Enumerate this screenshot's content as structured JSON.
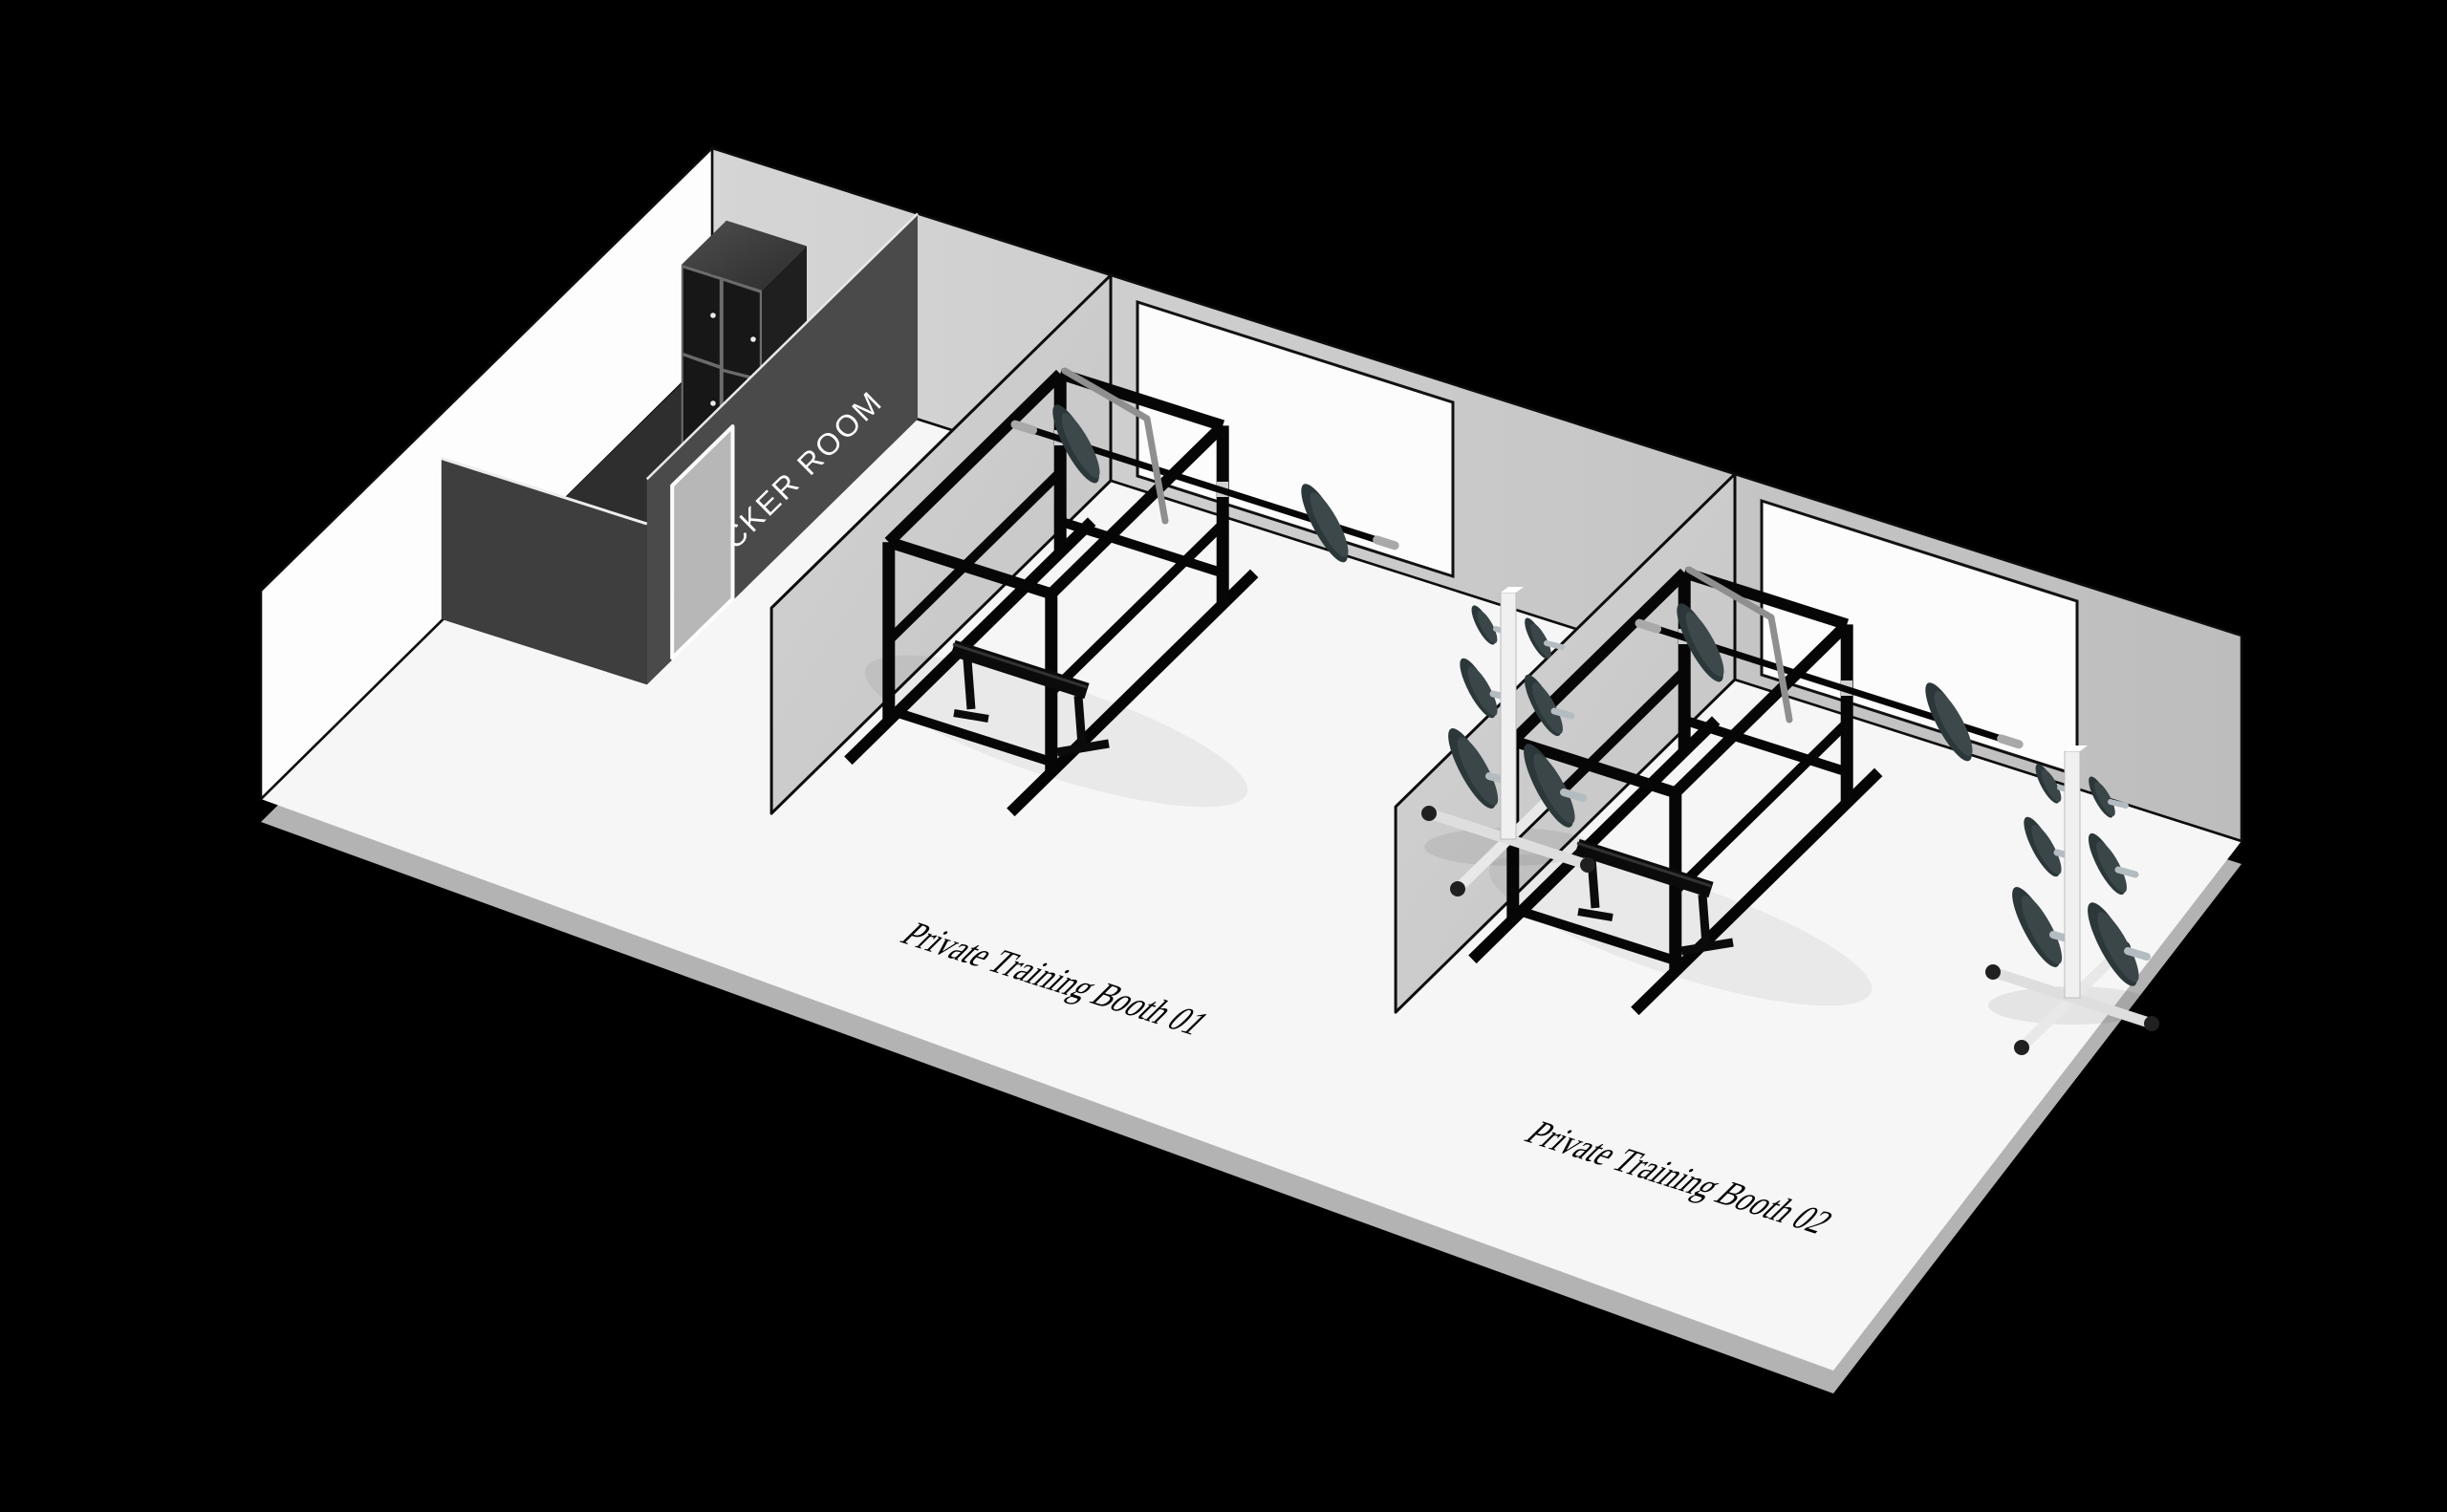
{
  "scene": {
    "type": "isometric-gym-floorplan-illustration",
    "background_color": "#000000",
    "locker_room": {
      "label": "LOCKER ROOM",
      "text_color": "#ffffff",
      "wall_color": "#4a4a4a",
      "objects": [
        "locker-cabinet-4-doors",
        "door"
      ]
    },
    "booths": [
      {
        "id": "01",
        "label": "Private Training Booth 01",
        "equipment": [
          "power-rack",
          "barbell-with-plates",
          "flat-bench",
          "mirror-board",
          "lat-bar"
        ]
      },
      {
        "id": "02",
        "label": "Private Training Booth 02",
        "equipment": [
          "power-rack",
          "barbell-with-plates",
          "flat-bench",
          "mirror-board",
          "lat-bar",
          "plate-tree"
        ]
      }
    ],
    "palette": {
      "floor": "#f6f6f6",
      "floor_edge_shadow": "#b3b3b3",
      "back_wall": "#c9c9c9",
      "left_wall": "#fdfdfd",
      "partition_wall": "#cccccc",
      "locker_walls": "#424242",
      "locker_cabinet": "#171717",
      "locker_door": "#b7b7b7",
      "equipment_black": "#060606",
      "weight_plate": "#2c3739",
      "metal_gray": "#aab4b8",
      "label_text": "#040404"
    }
  }
}
